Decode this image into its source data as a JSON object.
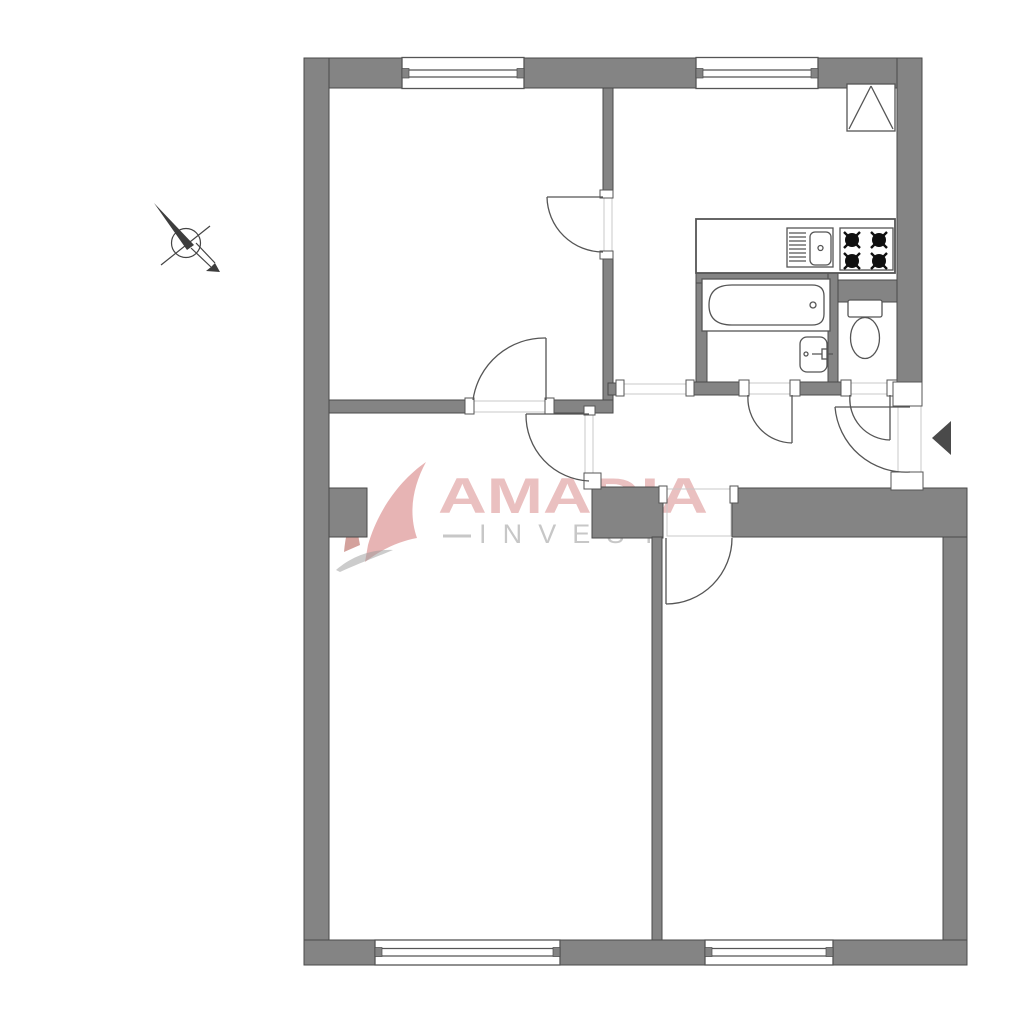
{
  "watermark": {
    "brand": "AMADIA",
    "sub": "INVEST"
  },
  "colors": {
    "background": "#ffffff",
    "wall-fill": "#848484",
    "wall-stroke": "#4a4a4a",
    "line": "#555555",
    "threshold": "#c9c9c9",
    "burner": "#101010",
    "entrance-arrow": "#4a4a4a",
    "wm-red": "#cf6a6a",
    "wm-gray": "#b5b5b5"
  },
  "icons": {
    "north_arrow": "north-arrow-icon",
    "entrance_arrow": "entrance-arrow-icon",
    "ventilation_shaft": "ventilation-shaft-icon"
  }
}
